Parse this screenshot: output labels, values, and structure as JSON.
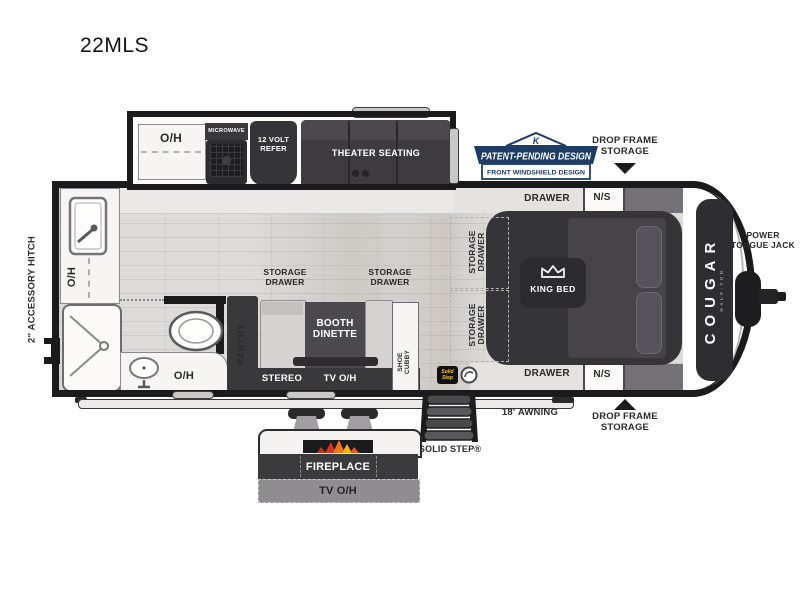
{
  "title": "22MLS",
  "brand": {
    "name": "COUGAR",
    "edition": "HALF-TON"
  },
  "badge": {
    "monogram": "K",
    "line1": "PATENT-PENDING DESIGN",
    "line2": "FRONT WINDSHIELD DESIGN"
  },
  "exterior": {
    "accessory_hitch": "2\" ACCESSORY HITCH",
    "power_tongue_jack": "POWER TONGUE JACK",
    "drop_frame_storage_top": "DROP FRAME STORAGE",
    "drop_frame_storage_bottom": "DROP FRAME STORAGE",
    "awning": "18' AWNING",
    "solid_step": "SOLID STEP®",
    "solid_step_logo": "Solid Step"
  },
  "kitchen": {
    "overhead_cabinet": "O/H",
    "microwave": "MICROWAVE",
    "refrigerator": "12 VOLT REFER",
    "theater_seating": "THEATER SEATING",
    "sink_overhead": "O/H",
    "pantry": "PANTRY"
  },
  "bathroom": {
    "overhead": "O/H"
  },
  "living": {
    "storage_drawer_left": "STORAGE DRAWER",
    "storage_drawer_right": "STORAGE DRAWER",
    "booth_dinette": "BOOTH DINETTE",
    "stereo": "STEREO",
    "tv_overhead": "TV O/H",
    "shoe_cubby": "SHOE CUBBY"
  },
  "bedroom": {
    "king_bed": "KING BED",
    "drawer_top": "DRAWER",
    "nightstand_top": "N/S",
    "drawer_bottom": "DRAWER",
    "nightstand_bottom": "N/S",
    "storage_drawer_1": "STORAGE DRAWER",
    "storage_drawer_2": "STORAGE DRAWER"
  },
  "outdoor": {
    "fireplace": "FIREPLACE",
    "tv_overhead": "TV O/H"
  },
  "colors": {
    "wall": "#1b1b1d",
    "furniture": "#39383b",
    "navy": "#1e3c64",
    "step_yellow": "#f2cf1b",
    "floor": "#dcdbda"
  }
}
